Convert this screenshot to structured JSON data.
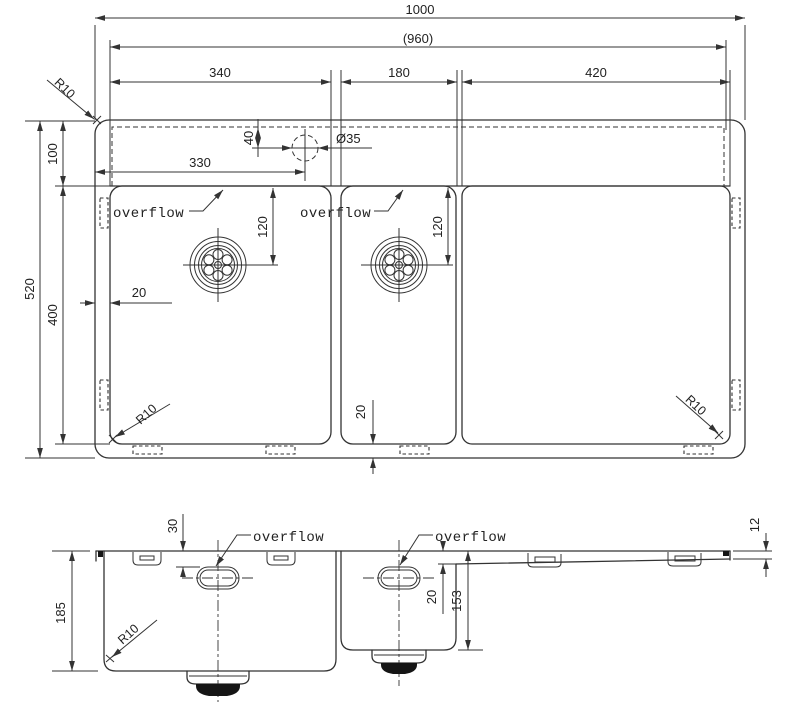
{
  "colors": {
    "line": "#333333",
    "background": "#ffffff"
  },
  "top_view": {
    "dim_overall_width": "1000",
    "dim_inner_width": "(960)",
    "dim_bowl1_width": "340",
    "dim_bowl2_width": "180",
    "dim_drainboard_width": "420",
    "dim_overall_depth": "520",
    "dim_ledge_depth": "100",
    "dim_bowl_depth": "400",
    "dim_tap_hole_offset": "330",
    "dim_tap_hole_setback": "40",
    "dim_tap_hole_diameter": "Ø35",
    "dim_drain1_offset": "120",
    "dim_drain2_offset": "120",
    "dim_side_gap": "20",
    "dim_bottom_gap": "20",
    "radius_top_left": "R10",
    "radius_bottom_left": "R10",
    "radius_bottom_right": "R10",
    "label_overflow_left": "overflow",
    "label_overflow_right": "overflow"
  },
  "front_view": {
    "dim_bowl1_depth": "185",
    "dim_overflow_drop": "30",
    "dim_drainboard_drop": "20",
    "dim_bowl2_depth": "153",
    "dim_edge_height": "12",
    "radius_bottom_left": "R10",
    "label_overflow_left": "overflow",
    "label_overflow_right": "overflow"
  }
}
